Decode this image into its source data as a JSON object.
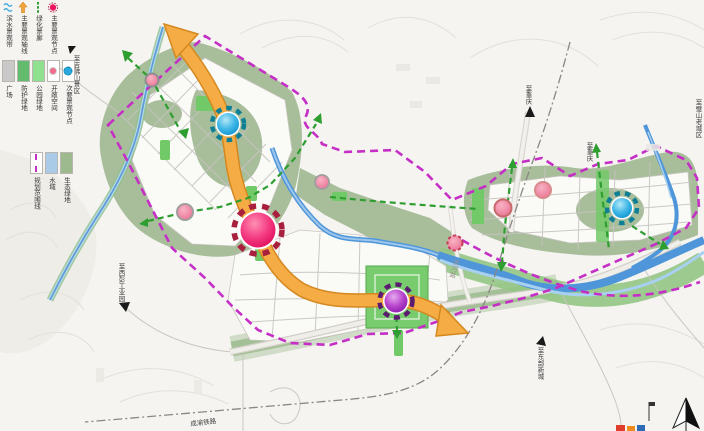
{
  "legend": {
    "line_items": [
      {
        "label": "滨水景观带",
        "symbol": "wavy-water-line",
        "color": "#3fa9dc"
      },
      {
        "label": "主要景观轴线",
        "symbol": "orange-axis-arrow",
        "color": "#f3a33c"
      },
      {
        "label": "绿化景廊",
        "symbol": "green-dashed-corridor",
        "color": "#2e9e31"
      },
      {
        "label": "主要景观节点",
        "symbol": "red-node-circle",
        "color": "#ec1560"
      }
    ],
    "swatch_items": [
      {
        "label": "广场",
        "color": "#c9c9c9"
      },
      {
        "label": "防护绿地",
        "color": "#63bb6e"
      },
      {
        "label": "公园绿地",
        "color": "#8fe08f"
      },
      {
        "label": "开敞空间",
        "color": "#ffffff",
        "dot": "#f06a8c"
      },
      {
        "label": "次要景观节点",
        "color": "#ffffff",
        "dot": "#28a8de"
      }
    ],
    "area_items": [
      {
        "label": "规划范围线",
        "color": "#ffffff",
        "line": "#c52fc5"
      },
      {
        "label": "水域",
        "color": "#a9cbe8"
      },
      {
        "label": "生态绿地",
        "color": "#9cba8e"
      }
    ]
  },
  "map_labels": {
    "to_jifo_mountain": "至吉佛山景区",
    "to_chongqing_1": "至重庆",
    "to_chongqing_2": "至重庆",
    "to_bishan_old_town": "至璧山老城区",
    "to_xipeng_industrial": "至西彭工业园",
    "to_east_new_town": "至东部新城",
    "railway_name": "成渝铁路",
    "riverside_road": "滨河路"
  },
  "colors": {
    "boundary_magenta": "#c52fc5",
    "axis_orange": "#f3a33c",
    "corridor_green": "#2e9e31",
    "main_node_pink": "#ec1560",
    "secondary_node_cyan": "#129fd8",
    "tertiary_node_purple": "#9121b2",
    "open_space_pink": "#ee7e9a",
    "eco_green": "#a8be9b",
    "park_green": "#79cc6d",
    "water_blue": "#4e96d9",
    "background": "#f5f4f1"
  }
}
